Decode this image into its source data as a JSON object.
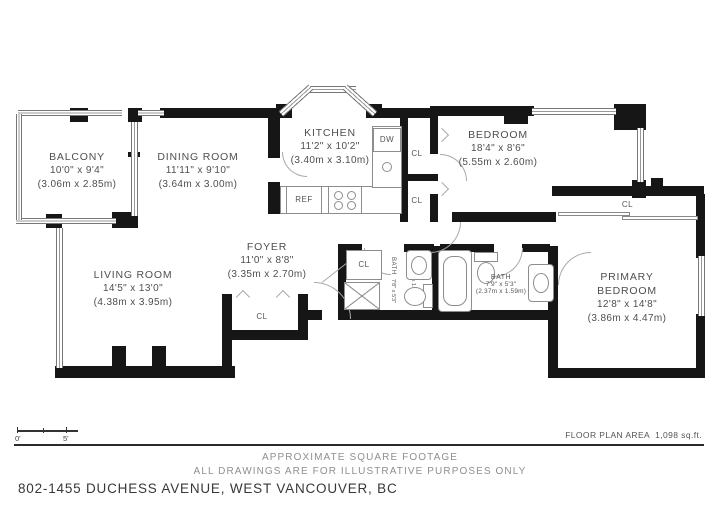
{
  "rooms": {
    "balcony": {
      "name": "BALCONY",
      "size_imperial": "10'0\" x 9'4\"",
      "size_metric": "(3.06m x 2.85m)"
    },
    "dining_room": {
      "name": "DINING ROOM",
      "size_imperial": "11'11\" x 9'10\"",
      "size_metric": "(3.64m x 3.00m)"
    },
    "kitchen": {
      "name": "KITCHEN",
      "size_imperial": "11'2\" x 10'2\"",
      "size_metric": "(3.40m x 3.10m)"
    },
    "bedroom": {
      "name": "BEDROOM",
      "size_imperial": "18'4\" x 8'6\"",
      "size_metric": "(5.55m x 2.60m)"
    },
    "living_room": {
      "name": "LIVING ROOM",
      "size_imperial": "14'5\" x 13'0\"",
      "size_metric": "(4.38m x 3.95m)"
    },
    "foyer": {
      "name": "FOYER",
      "size_imperial": "11'0\" x 8'8\"",
      "size_metric": "(3.35m x 2.70m)"
    },
    "primary_bedroom": {
      "name_line1": "PRIMARY",
      "name_line2": "BEDROOM",
      "size_imperial": "12'8\" x 14'8\"",
      "size_metric": "(3.86m x 4.47m)"
    },
    "bath_small": {
      "name": "BATH",
      "size_imperial": "7'8\" x 5'3\"",
      "size_metric": "(2.35m x 1.59m)"
    },
    "bath_main": {
      "name": "BATH",
      "size_imperial": "7'9\" x 5'3\"",
      "size_metric": "(2.37m x 1.59m)"
    }
  },
  "labels": {
    "closet": "CL",
    "dishwasher": "DW",
    "refrigerator": "REF"
  },
  "scale_bar": {
    "start": "0'",
    "end": "5'"
  },
  "notes": {
    "area": "FLOOR PLAN AREA  1,098 sq.ft.",
    "footer_line1": "APPROXIMATE SQUARE FOOTAGE",
    "footer_line2": "ALL DRAWINGS ARE FOR ILLUSTRATIVE PURPOSES ONLY",
    "address": "802-1455 DUCHESS AVENUE, WEST VANCOUVER, BC"
  }
}
